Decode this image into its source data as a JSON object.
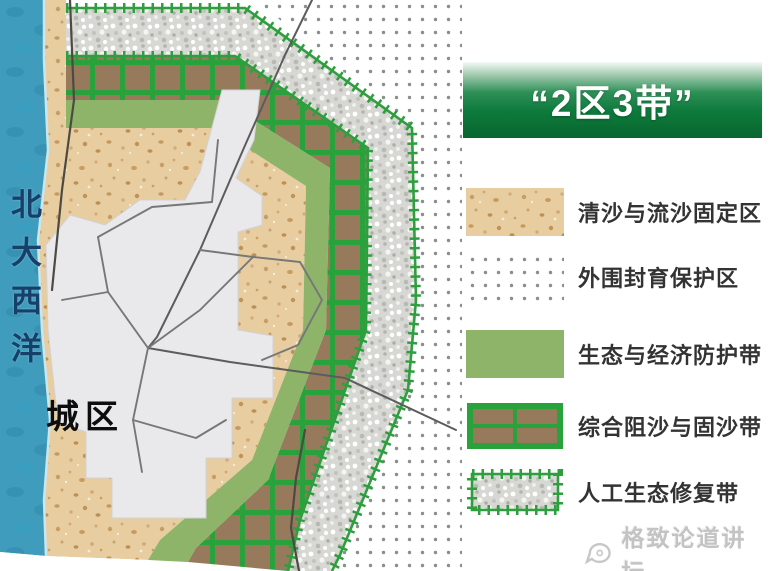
{
  "banner": {
    "title": "“2区3带”"
  },
  "map": {
    "ocean_label": "北大西洋",
    "city_label": "城区"
  },
  "legend": {
    "items": [
      {
        "label": "清沙与流沙固定区",
        "swatch": "sand-texture"
      },
      {
        "label": "外围封育保护区",
        "swatch": "dotted-pattern"
      },
      {
        "label": "生态与经济防护带",
        "swatch": "solid-green"
      },
      {
        "label": "综合阻沙与固沙带",
        "swatch": "green-grid-brown"
      },
      {
        "label": "人工生态修复带",
        "swatch": "gravel-spikes"
      }
    ]
  },
  "watermark": {
    "text": "格致论道讲坛"
  },
  "colors": {
    "ocean": "#3f9cbd",
    "ocean_text": "#16406a",
    "sand": "#e7cda0",
    "solid_green_belt": "#8db469",
    "grid_belt_green": "#2aa23c",
    "grid_belt_brown": "#967a5b",
    "gravel": "#dbdbd8",
    "dots": "#8d8d8d",
    "urban": "#e9e9ec",
    "banner_green_dark": "#09662f",
    "banner_green_mid": "#0d7a3c"
  }
}
